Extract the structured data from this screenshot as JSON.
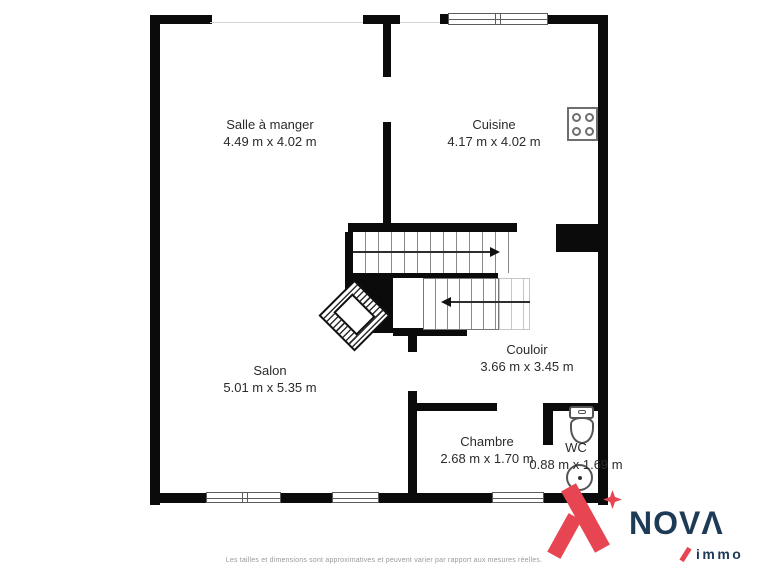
{
  "plan": {
    "rooms": [
      {
        "name": "Salle à manger",
        "dims": "4.49 m x 4.02 m"
      },
      {
        "name": "Cuisine",
        "dims": "4.17 m x 4.02 m"
      },
      {
        "name": "Salon",
        "dims": "5.01 m x 5.35 m"
      },
      {
        "name": "Couloir",
        "dims": "3.66 m x 3.45 m"
      },
      {
        "name": "Chambre",
        "dims": "2.68 m x 1.70 m"
      },
      {
        "name": "WC",
        "dims": "0.88 m x 1.69 m"
      }
    ]
  },
  "branding": {
    "logo_text": "NOVΛ",
    "logo_sub": "immo",
    "red": "#e84552",
    "navy": "#1d3a57"
  },
  "footer": {
    "disclaimer": "Les tailles et dimensions sont approximatives et peuvent varier par rapport aux mesures réelles."
  }
}
